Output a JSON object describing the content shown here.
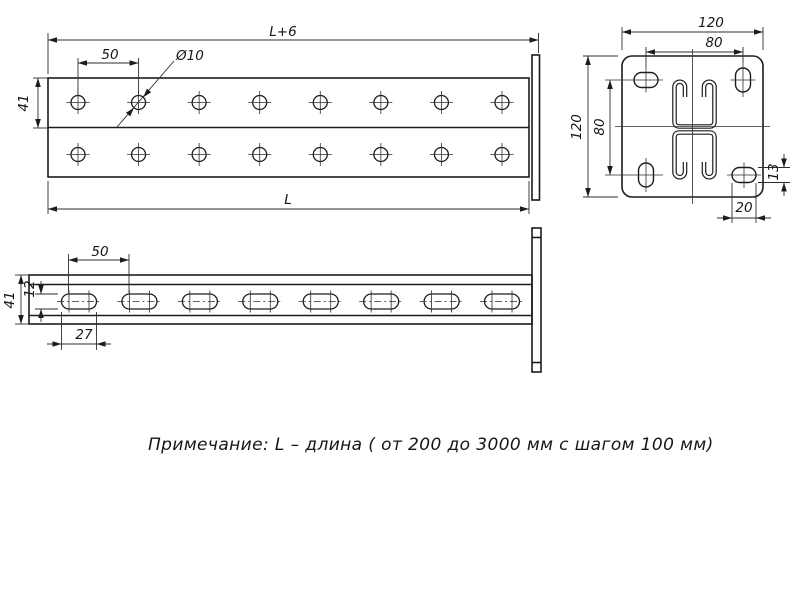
{
  "note": {
    "text": "Примечание: L – длина ( от 200 до 3000 мм с шагом 100 мм)"
  },
  "colors": {
    "line": "#1c1c1c",
    "thin": "#2e2e2e",
    "bg": "#ffffff"
  },
  "top_view": {
    "dims": {
      "overall_with_plate": "L+6",
      "length": "L",
      "hole_pitch": "50",
      "hole_diameter": "Ø10",
      "row_width": "41"
    },
    "holes": {
      "rows_y": [
        102.5,
        154.5
      ],
      "start_x": 78,
      "pitch": 60.57,
      "count": 8,
      "radius": 7,
      "tick": 11.5
    }
  },
  "end_view": {
    "dims": {
      "plate_width": "120",
      "hole_pitch_horizontal": "80",
      "plate_height": "120",
      "hole_pitch_vertical": "80",
      "slot_height": "13",
      "slot_width": "20"
    }
  },
  "side_view": {
    "dims": {
      "slot_pitch": "50",
      "profile_height": "41",
      "slot_height": "12",
      "slot_length": "27"
    },
    "slots": {
      "y": 301.5,
      "start_x": 79,
      "pitch": 60.43,
      "count": 8,
      "length": 35,
      "height": 15,
      "cross_offset": 10,
      "tick_half": 11,
      "dash_half": 22
    }
  }
}
